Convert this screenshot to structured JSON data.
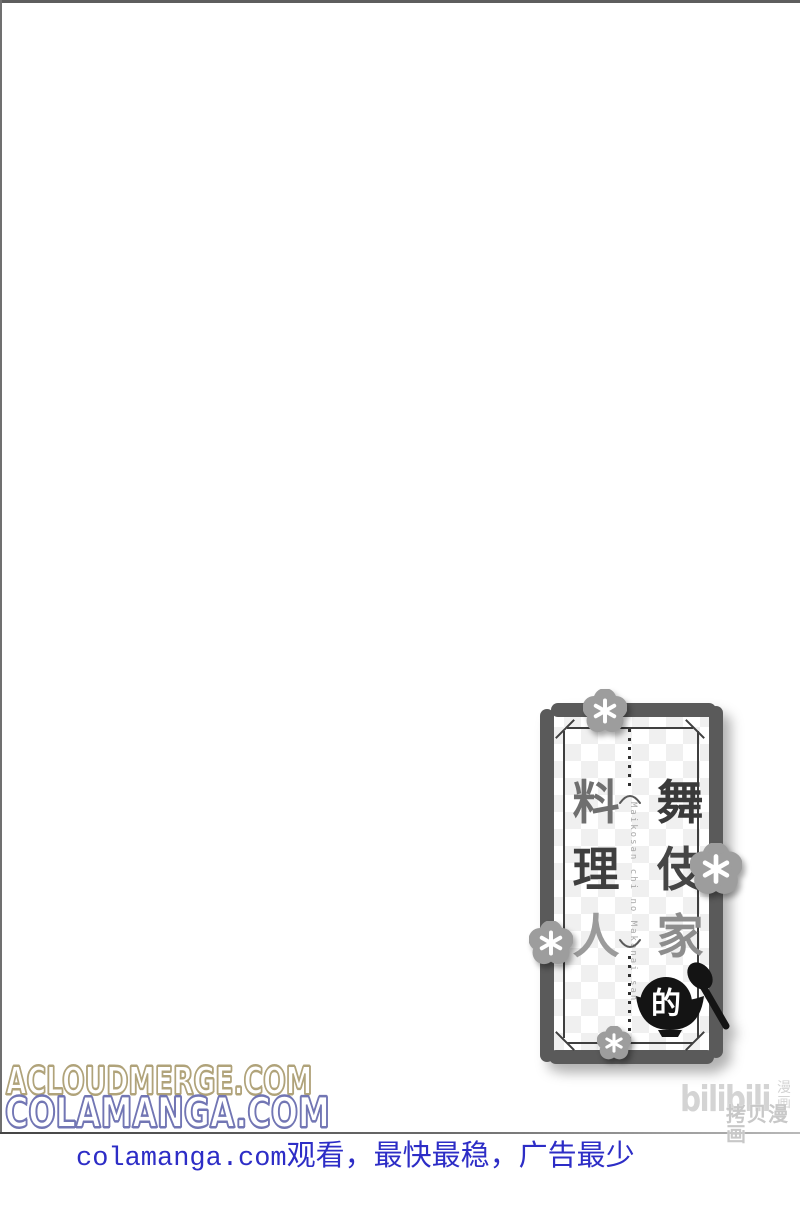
{
  "page": {
    "background": "#ffffff",
    "border_top_color": "#5e5e5e",
    "border_left_color": "#707070",
    "rule_color": "#6a6a6a"
  },
  "title_card": {
    "border_color": "#5a5a5a",
    "checker_color": "#f0f0f0",
    "flower_color": "#9d9d9d",
    "right_column_chars": [
      {
        "char": "舞",
        "color": "#3a3a3a"
      },
      {
        "char": "伎",
        "color": "#454545"
      },
      {
        "char": "家",
        "color": "#8d8d8d"
      }
    ],
    "left_column_chars": [
      {
        "char": "料",
        "color": "#6f6f6f"
      },
      {
        "char": "理",
        "color": "#3f3f3f"
      },
      {
        "char": "人",
        "color": "#9b9b9b"
      }
    ],
    "particle": "的",
    "romaji": "Maikosan chi no Makanai san"
  },
  "watermarks": {
    "line1": {
      "text": "ACLOUDMERGE.COM",
      "outline_color": "#b0a37a"
    },
    "line2": {
      "text": "COLAMANGA.COM",
      "outline_color": "#7276b4"
    },
    "bilibili": {
      "wordmark": "bilibili",
      "vertical_label": "漫画",
      "caption": "拷贝漫画",
      "color": "#d2d2d2"
    }
  },
  "footer": {
    "latin": "colamanga.com",
    "cjk": "观看，最快最稳，广告最少",
    "color": "#2d2dc6"
  }
}
